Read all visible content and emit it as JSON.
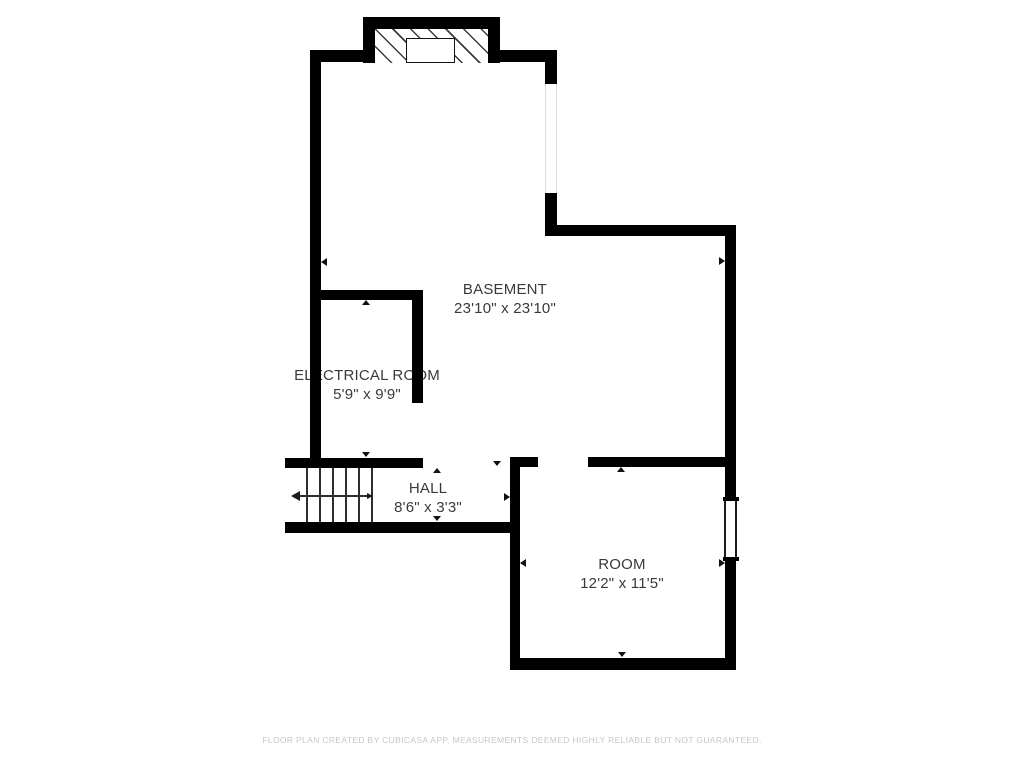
{
  "plan": {
    "type": "basement-floor-plan",
    "rooms": {
      "basement": {
        "name": "BASEMENT",
        "dims": "23'10\" x 23'10\""
      },
      "electrical": {
        "name": "ELECTRICAL ROOM",
        "dims": "5'9\" x 9'9\""
      },
      "hall": {
        "name": "HALL",
        "dims": "8'6\" x 3'3\""
      },
      "room": {
        "name": "ROOM",
        "dims": "12'2\" x 11'5\""
      }
    },
    "symbols": {
      "stairs": "stair-treads-with-down-arrow",
      "stairwell_hatch": "diagonal-hatch",
      "window": "double-line-window",
      "opening": "wall-opening",
      "measure_markers": "small-triangle-arrows"
    },
    "colors": {
      "wall": "#000000",
      "label_text": "#3a3a3a",
      "footer_text": "#c7c7c7",
      "background": "#ffffff"
    }
  },
  "footer": {
    "disclaimer": "FLOOR PLAN CREATED BY CUBICASA APP. MEASUREMENTS DEEMED HIGHLY RELIABLE BUT NOT GUARANTEED."
  }
}
